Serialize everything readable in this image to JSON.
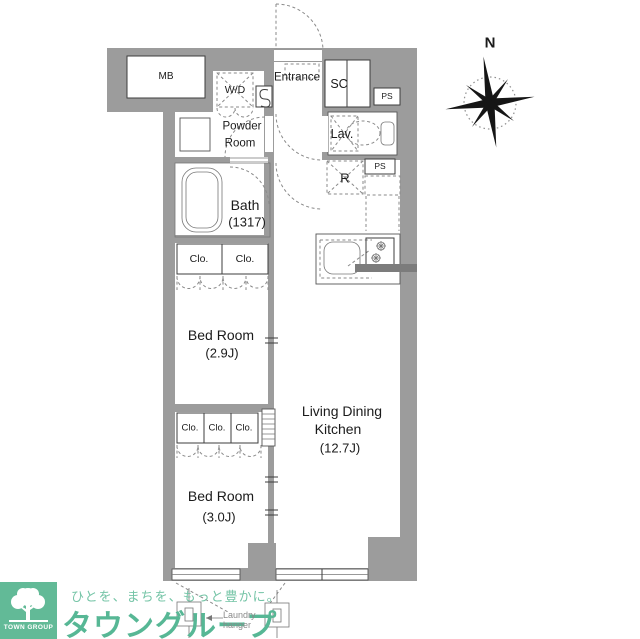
{
  "plan": {
    "labels": {
      "mb": "MB",
      "wd": "W/D",
      "entrance": "Entrance",
      "sc": "SC",
      "ps_top": "PS",
      "lav": "Lav.",
      "ps_mid": "PS",
      "refrigerator": "R",
      "powder_line1": "Powder",
      "powder_line2": "Room",
      "bath_name": "Bath",
      "bath_size": "(1317)",
      "closet": "Clo.",
      "bedroom1_name": "Bed Room",
      "bedroom1_size": "(2.9J)",
      "bedroom2_name": "Bed Room",
      "bedroom2_size": "(3.0J)",
      "ldk_line1": "Living Dining",
      "ldk_line2": "Kitchen",
      "ldk_size": "(12.7J)"
    },
    "compass_label": "N",
    "laundry_hanger_label": "Laundry hanger"
  },
  "branding": {
    "tagline": "ひとを、まちを、もっと豊かに。",
    "logo_text": "タウングループ",
    "badge_text": "TOWN GROUP"
  },
  "colors": {
    "wall_gray": "#9c9c9c",
    "brand_green": "#5cb797",
    "line_dark": "#333333"
  }
}
